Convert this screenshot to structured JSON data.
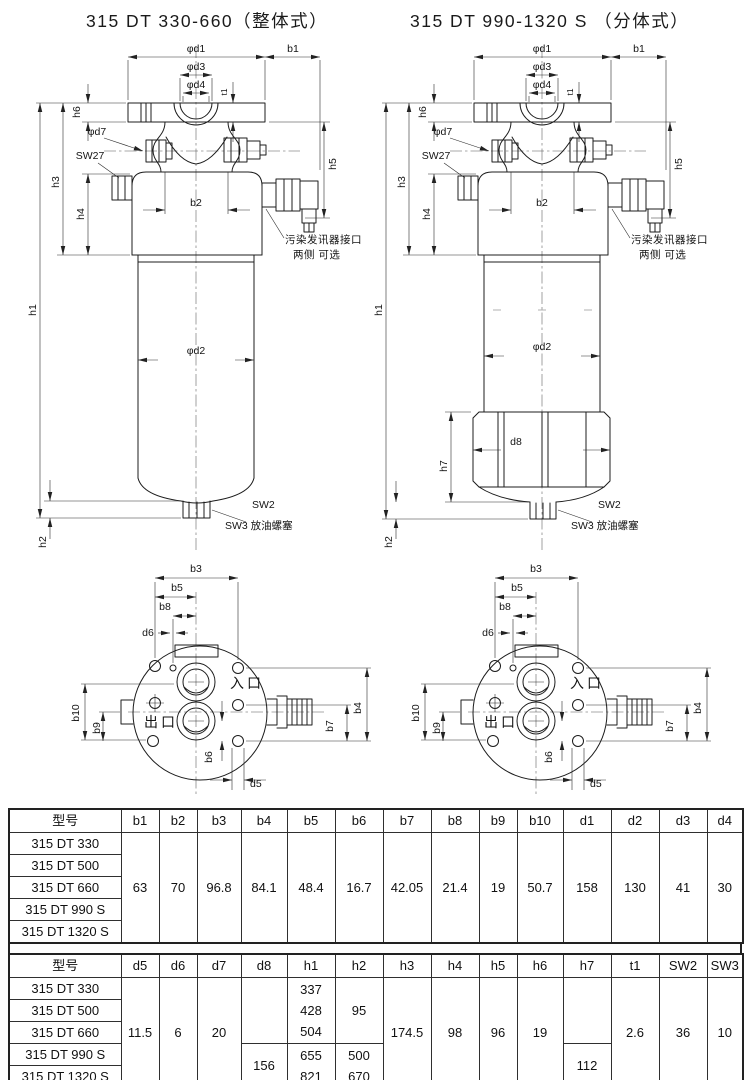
{
  "titles": {
    "left": "315 DT 330-660（整体式）",
    "right": "315 DT 990-1320 S （分体式）"
  },
  "labels": {
    "phi_d1": "φd1",
    "phi_d3": "φd3",
    "phi_d4": "φd4",
    "phi_d7": "φd7",
    "phi_d2": "φd2",
    "b1": "b1",
    "b2": "b2",
    "t1": "t1",
    "h1": "h1",
    "h2": "h2",
    "h3": "h3",
    "h4": "h4",
    "h5": "h5",
    "h6": "h6",
    "h7": "h7",
    "d8": "d8",
    "sw27": "SW27",
    "sw2": "SW2",
    "sw3_note": "SW3 放油螺塞",
    "sensor_note_line1": "污染发讯器接口",
    "sensor_note_line2": "两侧 可选"
  },
  "bottom_view": {
    "b3": "b3",
    "b5": "b5",
    "b8": "b8",
    "d6": "d6",
    "b10": "b10",
    "b9": "b9",
    "b4": "b4",
    "b7": "b7",
    "b6": "b6",
    "d5": "d5",
    "inlet": "入口",
    "outlet": "出口"
  },
  "models": [
    "315 DT 330",
    "315 DT 500",
    "315 DT 660",
    "315 DT 990 S",
    "315 DT 1320 S"
  ],
  "table1": {
    "headers": [
      "型号",
      "b1",
      "b2",
      "b3",
      "b4",
      "b5",
      "b6",
      "b7",
      "b8",
      "b9",
      "b10",
      "d1",
      "d2",
      "d3",
      "d4"
    ],
    "values": [
      "63",
      "70",
      "96.8",
      "84.1",
      "48.4",
      "16.7",
      "42.05",
      "21.4",
      "19",
      "50.7",
      "158",
      "130",
      "41",
      "30"
    ]
  },
  "table2": {
    "headers": [
      "型号",
      "d5",
      "d6",
      "d7",
      "d8",
      "h1",
      "h2",
      "h3",
      "h4",
      "h5",
      "h6",
      "h7",
      "t1",
      "SW2",
      "SW3"
    ],
    "d5": "11.5",
    "d6": "6",
    "d7": "20",
    "d8": "156",
    "h1": [
      "337",
      "428",
      "504",
      "655",
      "821"
    ],
    "h2_upper": "95",
    "h2_lower": [
      "500",
      "670"
    ],
    "h3": "174.5",
    "h4": "98",
    "h5": "96",
    "h6": "19",
    "h7": "112",
    "t1": "2.6",
    "sw2": "36",
    "sw3": "10"
  }
}
